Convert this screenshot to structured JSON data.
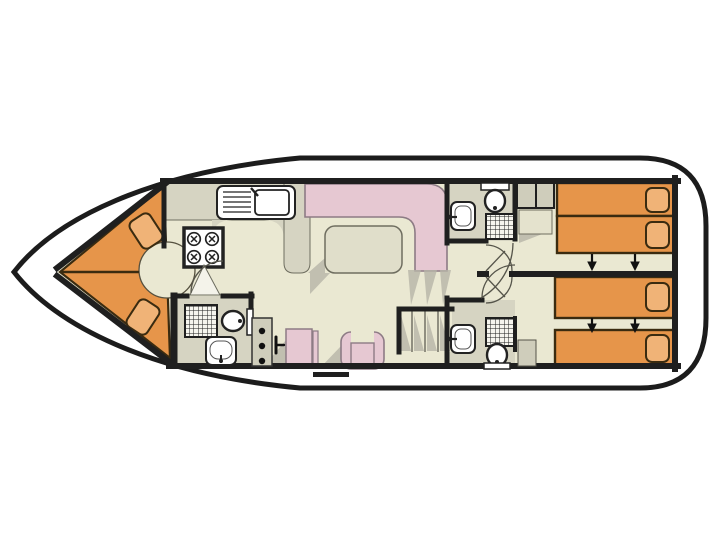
{
  "page_bg": "#ffffff",
  "colors": {
    "page_bg": "#ffffff",
    "hull_outline": "#1c1c1c",
    "deck": "#ffffff",
    "wall": "#1f1f1f",
    "floor_beige": "#EAE8D2",
    "wet_room_gray": "#D6D4C2",
    "cabinet_gray": "#CFCDBB",
    "closet_beige": "#E4E2CD",
    "bed_orange": "#E6954A",
    "pillow_orange": "#F0B377",
    "bed_outline": "#3a2b10",
    "upholstery_pink": "#E6C8D2",
    "pink_outline": "#8d7b85",
    "table_fill": "#E0DECA",
    "outline": "#6f6e60",
    "shadow": "#B6B4A7",
    "fixture_outline": "#222222",
    "arrow": "#111111"
  },
  "plan": {
    "vessel": "houseboat-floor-plan",
    "orientation": "bow-left-stern-right",
    "rooms": [
      {
        "name": "bow-cabin",
        "berth": "v-shaped-double",
        "pillows": 2
      },
      {
        "name": "galley",
        "fixtures": [
          "kitchen-sink",
          "stove-4-burner"
        ]
      },
      {
        "name": "forward-bathroom",
        "fixtures": [
          "shower",
          "toilet",
          "washbasin"
        ]
      },
      {
        "name": "helm-station",
        "fixtures": [
          "instrument-console",
          "steering-wheel",
          "helm-seat"
        ]
      },
      {
        "name": "saloon",
        "fixtures": [
          "l-shaped-sofa",
          "table",
          "armchair"
        ]
      },
      {
        "name": "aft-bathroom-port",
        "fixtures": [
          "washbasin",
          "toilet",
          "shower"
        ]
      },
      {
        "name": "aft-bathroom-starboard",
        "fixtures": [
          "washbasin",
          "shower",
          "toilet",
          "cabinet"
        ]
      },
      {
        "name": "wardrobe",
        "compartments": 3
      },
      {
        "name": "stairs",
        "flights": 2
      },
      {
        "name": "aft-cabin-port",
        "beds": 2,
        "slide_arrows": 2
      },
      {
        "name": "aft-cabin-starboard",
        "beds": 2,
        "slide_arrows": 2
      }
    ],
    "single_beds_total": 4,
    "bed_slide_arrows_total": 4,
    "boarding_step_marker": 1
  }
}
